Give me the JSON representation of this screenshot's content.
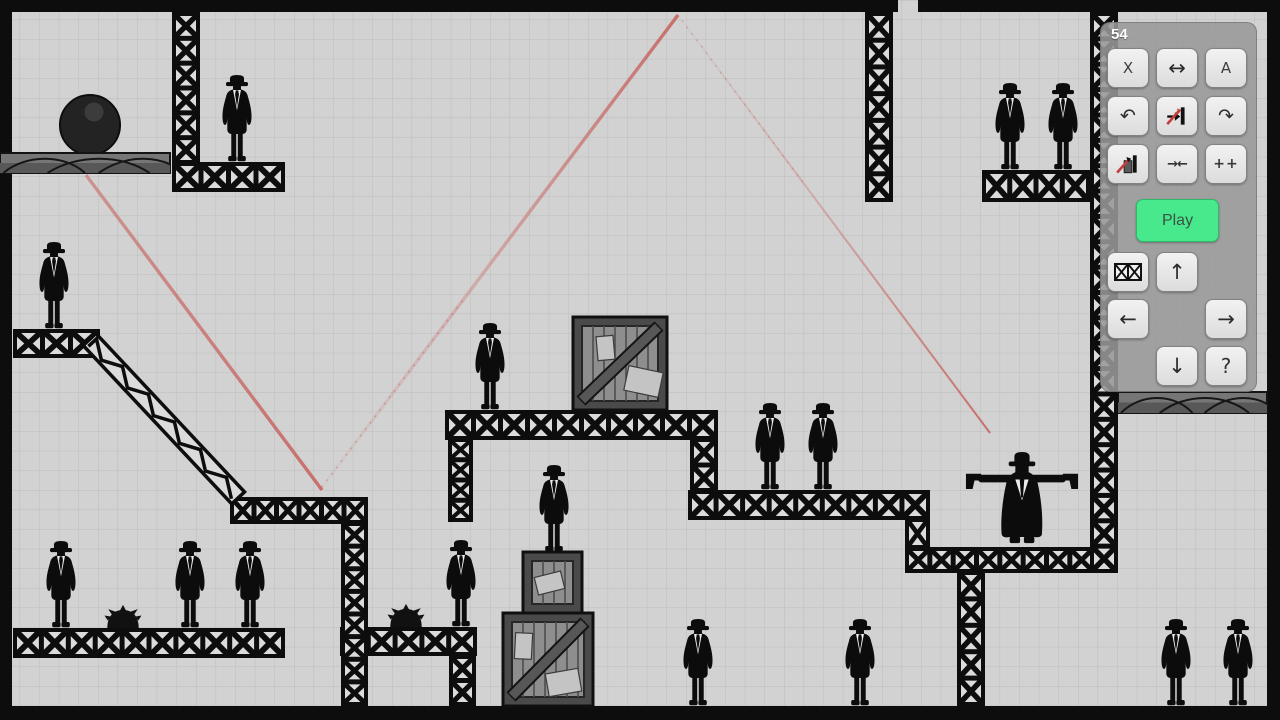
{
  "hud": {
    "counter": "54",
    "play_label": "Play",
    "buttons": {
      "delete": "X",
      "mirror": "↔",
      "a": "A",
      "undo": "↶",
      "redo": "↷",
      "collide": "→←",
      "plusplus": "++",
      "up": "↑",
      "down": "↓",
      "left": "←",
      "right": "→",
      "help": "?"
    }
  },
  "colors": {
    "background": "#d2d2d2",
    "grid_line": "#bcbcbc",
    "structure_black": "#0d0d0d",
    "truss_cell": "#dbdbdb",
    "slab_gray": "#767676",
    "slab_band": "#585858",
    "crate_frame": "#4a4a4a",
    "crate_planks": "#8e8e8e",
    "crate_brace": "#575757",
    "crate_label": "#c4c4c4",
    "trajectory_red": "#c76a66",
    "accent_green": "#47e98c",
    "panel_gray": "#999999"
  },
  "level": {
    "walls": [
      [
        0,
        0,
        898,
        12
      ],
      [
        918,
        0,
        362,
        12
      ],
      [
        0,
        12,
        12,
        708
      ],
      [
        1267,
        12,
        13,
        708
      ],
      [
        0,
        706,
        1280,
        14
      ]
    ],
    "trusses": [
      [
        172,
        12,
        28,
        152
      ],
      [
        172,
        162,
        113,
        30
      ],
      [
        13,
        329,
        87,
        29
      ],
      [
        230,
        497,
        138,
        27
      ],
      [
        445,
        410,
        273,
        30
      ],
      [
        448,
        438,
        25,
        84
      ],
      [
        690,
        438,
        28,
        54
      ],
      [
        688,
        490,
        242,
        30
      ],
      [
        905,
        518,
        25,
        31
      ],
      [
        905,
        547,
        213,
        26
      ],
      [
        957,
        571,
        28,
        135
      ],
      [
        1090,
        12,
        28,
        561
      ],
      [
        982,
        170,
        108,
        32
      ],
      [
        865,
        12,
        28,
        190
      ],
      [
        13,
        628,
        272,
        30
      ],
      [
        340,
        627,
        137,
        29
      ],
      [
        341,
        522,
        27,
        184
      ],
      [
        449,
        655,
        27,
        51
      ]
    ],
    "diagonals": [
      {
        "x1": 96,
        "y1": 331,
        "x2": 247,
        "y2": 492,
        "th": 21
      }
    ],
    "slabs": [
      [
        0,
        153,
        170,
        20
      ],
      [
        1118,
        392,
        149,
        21
      ]
    ],
    "crates": [
      {
        "x": 573,
        "y": 317,
        "w": 94,
        "h": 93,
        "brace": true,
        "labels": [
          [
            597,
            336,
            17,
            24,
            -5
          ],
          [
            626,
            369,
            35,
            25,
            12
          ]
        ]
      },
      {
        "x": 523,
        "y": 552,
        "w": 59,
        "h": 61,
        "brace": false,
        "labels": [
          [
            536,
            574,
            27,
            18,
            -14
          ]
        ]
      },
      {
        "x": 503,
        "y": 613,
        "w": 90,
        "h": 93,
        "brace": true,
        "labels": [
          [
            515,
            633,
            17,
            26,
            3
          ],
          [
            547,
            671,
            33,
            23,
            -10
          ]
        ]
      }
    ],
    "ball": {
      "cx": 90,
      "cy": 125,
      "r": 30,
      "hx": 94,
      "hy": 112,
      "hr": 9.5
    },
    "mines": [
      [
        123,
        628
      ],
      [
        406,
        627
      ]
    ],
    "enemies": [
      [
        237,
        163
      ],
      [
        54,
        330
      ],
      [
        490,
        411
      ],
      [
        770,
        491
      ],
      [
        823,
        491
      ],
      [
        1010,
        171
      ],
      [
        1063,
        171
      ],
      [
        61,
        629
      ],
      [
        190,
        629
      ],
      [
        250,
        629
      ],
      [
        461,
        628
      ],
      [
        554,
        553
      ],
      [
        698,
        707
      ],
      [
        860,
        707
      ],
      [
        1176,
        707
      ],
      [
        1238,
        707
      ]
    ],
    "shooter": {
      "x": 1022,
      "y": 546
    },
    "trajectory": [
      {
        "x1": 990,
        "y1": 433,
        "x2": 678,
        "y2": 15,
        "w": 2,
        "tail": true
      },
      {
        "x1": 678,
        "y1": 15,
        "x2": 319,
        "y2": 491,
        "w": 3.4,
        "tail": true
      },
      {
        "x1": 322,
        "y1": 490,
        "x2": 86,
        "y2": 175,
        "w": 3.4,
        "tail": false
      }
    ]
  }
}
